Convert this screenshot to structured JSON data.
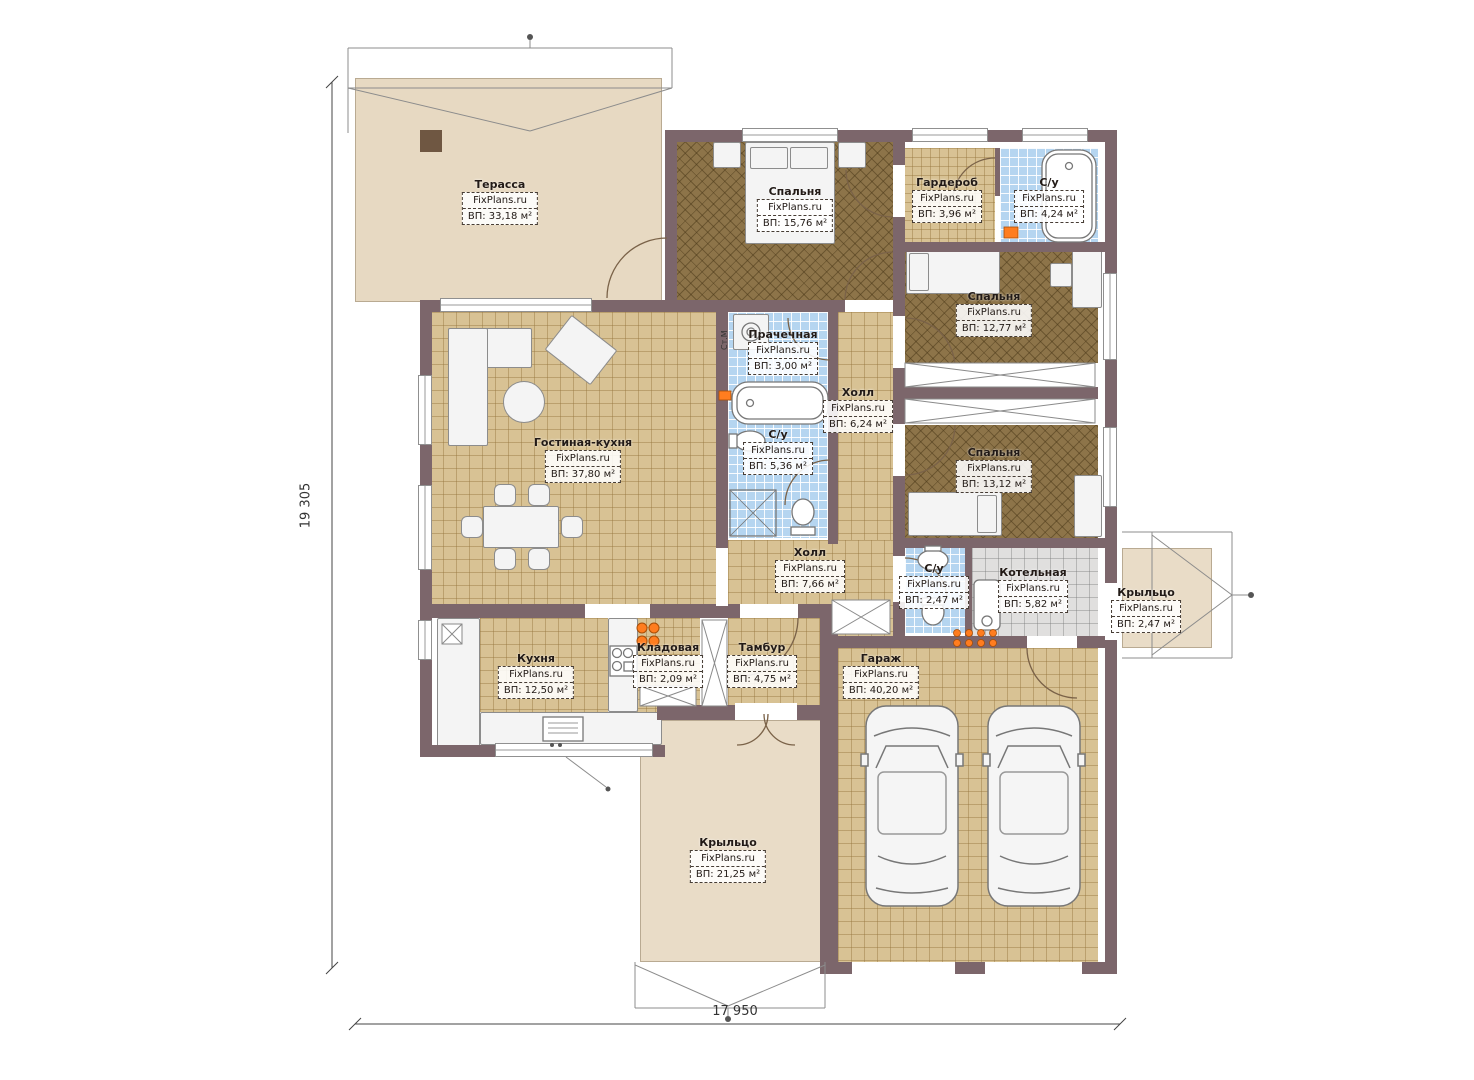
{
  "site": "FixPlans.ru",
  "dimensions": {
    "height_label": "19 305",
    "width_label": "17 950"
  },
  "annotations": {
    "washing_machine": "Ст.М"
  },
  "colors": {
    "wall": "#7c666b",
    "terrace_floor": "#e9dcc7",
    "tile_floor": "#d8c294",
    "bedroom_floor": "#8d7449",
    "wet_room_floor": "#b5d5f0",
    "boiler_floor": "#e0dfde",
    "accent_orange": "#ff7d1f"
  },
  "rooms": [
    {
      "name": "Терасса",
      "site": "FixPlans.ru",
      "area": "ВП: 33,18 м²"
    },
    {
      "name": "Спальня",
      "site": "FixPlans.ru",
      "area": "ВП: 15,76 м²"
    },
    {
      "name": "Гардероб",
      "site": "FixPlans.ru",
      "area": "ВП: 3,96 м²"
    },
    {
      "name": "С/у",
      "site": "FixPlans.ru",
      "area": "ВП: 4,24 м²"
    },
    {
      "name": "Спальня",
      "site": "FixPlans.ru",
      "area": "ВП: 12,77 м²"
    },
    {
      "name": "Прачечная",
      "site": "FixPlans.ru",
      "area": "ВП: 3,00 м²"
    },
    {
      "name": "Холл",
      "site": "FixPlans.ru",
      "area": "ВП: 6,24 м²"
    },
    {
      "name": "С/у",
      "site": "FixPlans.ru",
      "area": "ВП: 5,36 м²"
    },
    {
      "name": "Гостиная-кухня",
      "site": "FixPlans.ru",
      "area": "ВП: 37,80 м²"
    },
    {
      "name": "Спальня",
      "site": "FixPlans.ru",
      "area": "ВП: 13,12 м²"
    },
    {
      "name": "Холл",
      "site": "FixPlans.ru",
      "area": "ВП: 7,66 м²"
    },
    {
      "name": "С/у",
      "site": "FixPlans.ru",
      "area": "ВП: 2,47 м²"
    },
    {
      "name": "Котельная",
      "site": "FixPlans.ru",
      "area": "ВП: 5,82 м²"
    },
    {
      "name": "Крыльцо",
      "site": "FixPlans.ru",
      "area": "ВП: 2,47 м²"
    },
    {
      "name": "Кухня",
      "site": "FixPlans.ru",
      "area": "ВП: 12,50 м²"
    },
    {
      "name": "Кладовая",
      "site": "FixPlans.ru",
      "area": "ВП: 2,09 м²"
    },
    {
      "name": "Тамбур",
      "site": "FixPlans.ru",
      "area": "ВП: 4,75 м²"
    },
    {
      "name": "Гараж",
      "site": "FixPlans.ru",
      "area": "ВП: 40,20 м²"
    },
    {
      "name": "Крыльцо",
      "site": "FixPlans.ru",
      "area": "ВП: 21,25 м²"
    }
  ]
}
